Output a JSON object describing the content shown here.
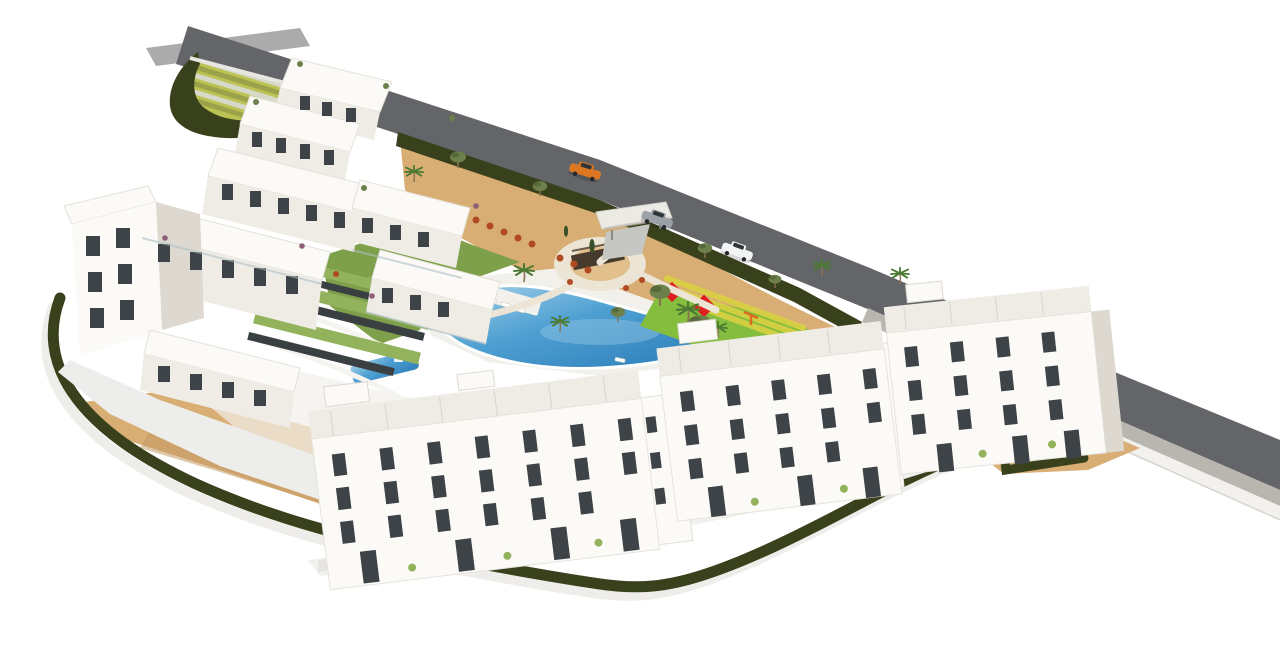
{
  "scene": {
    "description": "Aerial 3D architectural rendering of a white low-rise apartment complex with tiered penthouse blocks, landscaped gardens, a free-form swimming pool, a children's playground with red shade sails, a circular plaza, perimeter hedges and a diagonal asphalt road with three cars",
    "counts": {
      "pools": 2,
      "cars": 3,
      "shade_sails": 4,
      "apartment_blocks_bottom_row": 3
    },
    "cars": [
      {
        "name": "orange-sports-car",
        "color_key": "car_orange"
      },
      {
        "name": "silver-hatchback",
        "color_key": "car_silver"
      },
      {
        "name": "white-suv",
        "color_key": "car_white"
      }
    ],
    "features": [
      "tiered-white-apartment-cluster",
      "four-storey-apartment-row",
      "rooftop-terraces",
      "swimming-pool",
      "kids-pool",
      "sun-loungers",
      "lawn",
      "circular-plaza-with-feature-wall",
      "playground-red-shade-sails",
      "entrance-gate-canopy",
      "perimeter-hedge",
      "sand-gardens",
      "terraced-green-slope",
      "asphalt-road",
      "sidewalk",
      "retaining-wall",
      "palm-trees",
      "olive-trees",
      "flowering-shrubs",
      "gabion-stone-walls"
    ],
    "colors": {
      "background": "#ffffff",
      "building_face": "#fbfaf7",
      "building_face_shade": "#efece6",
      "building_side": "#ddd9d1",
      "roof_line": "#d8d4cc",
      "window_dark": "#3e4347",
      "road_asphalt": "#636568",
      "road_ramp": "#a7a7a7",
      "sidewalk": "#b9b6b0",
      "wall_white": "#f2f1ee",
      "hedge_dark": "#39411c",
      "hedge_mid": "#49541f",
      "path_outer": "#efede9",
      "path_cream": "#ece4d4",
      "deck_white": "#f2f0ea",
      "sand": "#d8ae74",
      "sand_light": "#e2c08d",
      "sand_shadow": "#c49a64",
      "lawn": "#7fa04b",
      "lawn_light": "#93b25c",
      "pool_light": "#a8d4ea",
      "pool_mid": "#4e9fd2",
      "pool_deep": "#2b7db8",
      "terrace_band_light": "#d6d8c8",
      "terrace_band_green": "#9aa24a",
      "terrace_band_yellow": "#bcc253",
      "gabion_dark": "#3a3f42",
      "plaza_wall": "#463a2d",
      "play_red": "#dd1f1f",
      "play_green": "#85bd3f",
      "play_yellow": "#d9cf43",
      "play_orange": "#d96a1e",
      "shrub_red": "#b04a22",
      "plant_purple": "#8f5f7a",
      "palm_green": "#4c7a33",
      "olive_green": "#6d7f4a",
      "tree_dark": "#37502a",
      "trunk_brown": "#8a7354",
      "car_orange": "#dd7722",
      "car_silver": "#9ba1a6",
      "car_white": "#f2f3f3",
      "car_glass": "#2f3438",
      "shadow_soft": "#ededeb",
      "shadow_mid": "#e2e0dc"
    }
  }
}
